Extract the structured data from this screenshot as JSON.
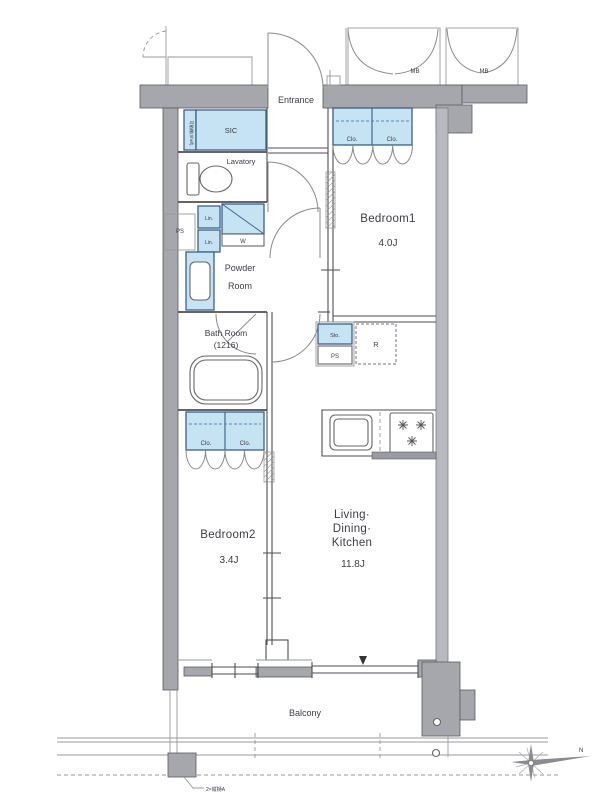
{
  "plan": {
    "rooms": {
      "entrance": "Entrance",
      "sic": "SIC",
      "sic_shelf": "可動棚(Shelf)",
      "lavatory": "Lavatory",
      "powder1": "Powder",
      "powder2": "Room",
      "bath1": "Bath Room",
      "bath2": "(1216)",
      "bedroom1": "Bedroom1",
      "bedroom1_size": "4.0J",
      "bedroom2": "Bedroom2",
      "bedroom2_size": "3.4J",
      "ldk1": "Living·",
      "ldk2": "Dining·",
      "ldk3": "Kitchen",
      "ldk_size": "11.8J",
      "balcony": "Balcony"
    },
    "fixtures": {
      "clo_b1_left": "Clo.",
      "clo_b1_right": "Clo.",
      "clo_b2_left": "Clo.",
      "clo_b2_right": "Clo.",
      "lin_top": "Lin.",
      "lin_bottom": "Lin.",
      "washer": "W",
      "storage": "Sto.",
      "fridge": "R",
      "ps_wall": "PS",
      "ps_kitchen": "PS",
      "mb_left": "MB",
      "mb_right": "MB"
    },
    "notes": {
      "downpipe": "2×縦樋A",
      "compass": "N"
    }
  }
}
